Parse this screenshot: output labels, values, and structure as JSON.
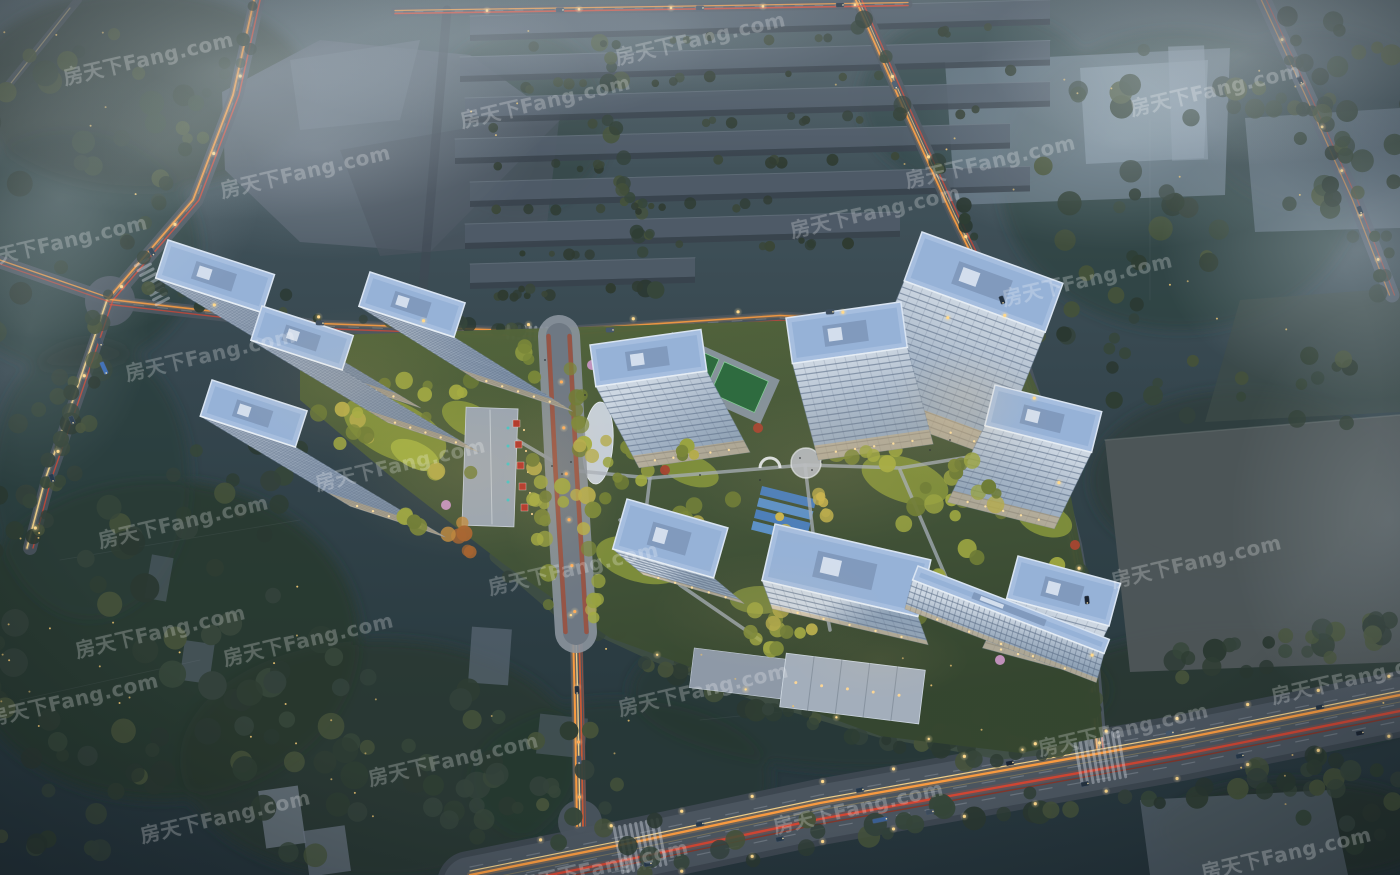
{
  "watermark": {
    "text": "房天下Fang.com"
  },
  "palette": {
    "bg_top": "#4a5a61",
    "bg_mid": "#35464e",
    "bg_bot": "#25343b",
    "tree_dark": "#2e3d33",
    "tree_dark2": "#36463a",
    "tree_olive": "#45523a",
    "tree_lit": "#99a341",
    "tree_lit2": "#b4ab4b",
    "tree_lit3": "#7a8739",
    "tree_orange": "#b5743a",
    "tree_pink": "#c795c2",
    "tree_red": "#a84632",
    "tower_body_light": "#cdd7e2",
    "tower_body_mid": "#a9b8c9",
    "tower_body_dark": "#8fa2b6",
    "floor_line": "#5d7088",
    "roof": "#a6bedf",
    "roof_inner": "#93b0d6",
    "roof_trim": "#d9e4f2",
    "roof_equip": "#7e97ba",
    "base_glow": "#d9ae66",
    "warehouse": "#4f5b68",
    "warehouse_shadow": "#39434d",
    "parcel_gray": "#56626e",
    "field_light": "#78899a",
    "field_dark": "#29342f",
    "field_gray": "#50585a",
    "road": "#4b555f",
    "road_light": "#6e7883",
    "sidewalk": "#8b939d",
    "bike_red": "#9e4f3c",
    "lane_line": "#cdd4da",
    "trail_orange": "#ff9d3f",
    "trail_yellow": "#ffd98c",
    "trail_red": "#dd4530",
    "trail_red_dim": "#8f2f1f",
    "lamp": "#ffd98c",
    "lantern": "#ffae5c",
    "twinkle": "#e7c070",
    "lawn": "#87963c",
    "lawn_bright": "#a8b545",
    "pool": "#4a7fc1",
    "pool2": "#5d93cf",
    "court": "#2e6b3f",
    "court_line": "#86d096",
    "path": "#a6aeb8",
    "site_n": "#55673a",
    "site_m": "#47583a",
    "site_s": "#35462f",
    "shop_red": "#b03328",
    "umbrella": "#3ec8c8",
    "clubhouse": "#a3aebb",
    "people": "#242b33"
  }
}
